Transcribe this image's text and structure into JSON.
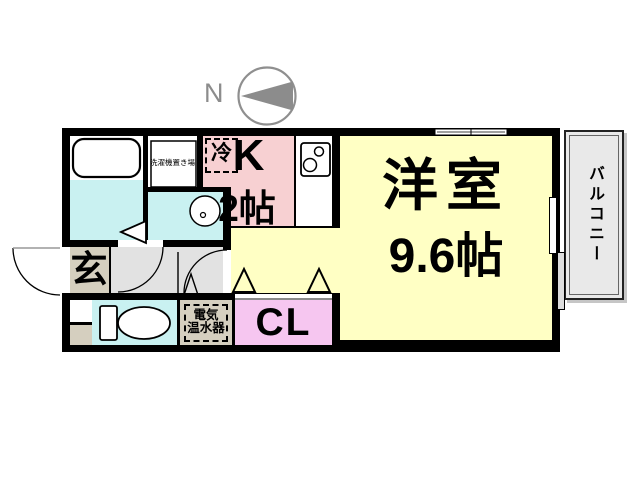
{
  "compass": {
    "north": "N"
  },
  "rooms": {
    "western": {
      "label": "洋室",
      "size": "9.6帖"
    },
    "kitchen": {
      "label": "K",
      "size": "2帖"
    },
    "closet": {
      "label": "CL"
    },
    "entrance": {
      "label": "玄"
    },
    "balcony": {
      "label": "バルコニー"
    }
  },
  "fixtures": {
    "refrigerator": "冷",
    "washing_machine": "洗濯機置き場",
    "water_heater_line1": "電気",
    "water_heater_line2": "温水器"
  },
  "colors": {
    "room_yellow": "#FFFFC4",
    "kitchen_pink": "#F7D0D2",
    "closet_pink": "#F6C6F0",
    "wet_cyan": "#C9F1F1",
    "beige": "#D5CFBF",
    "hall_gray": "#E2E2E2",
    "balcony_gray": "#E9E9E9",
    "wall_black": "#000000",
    "compass_gray": "#8C8C8C"
  }
}
